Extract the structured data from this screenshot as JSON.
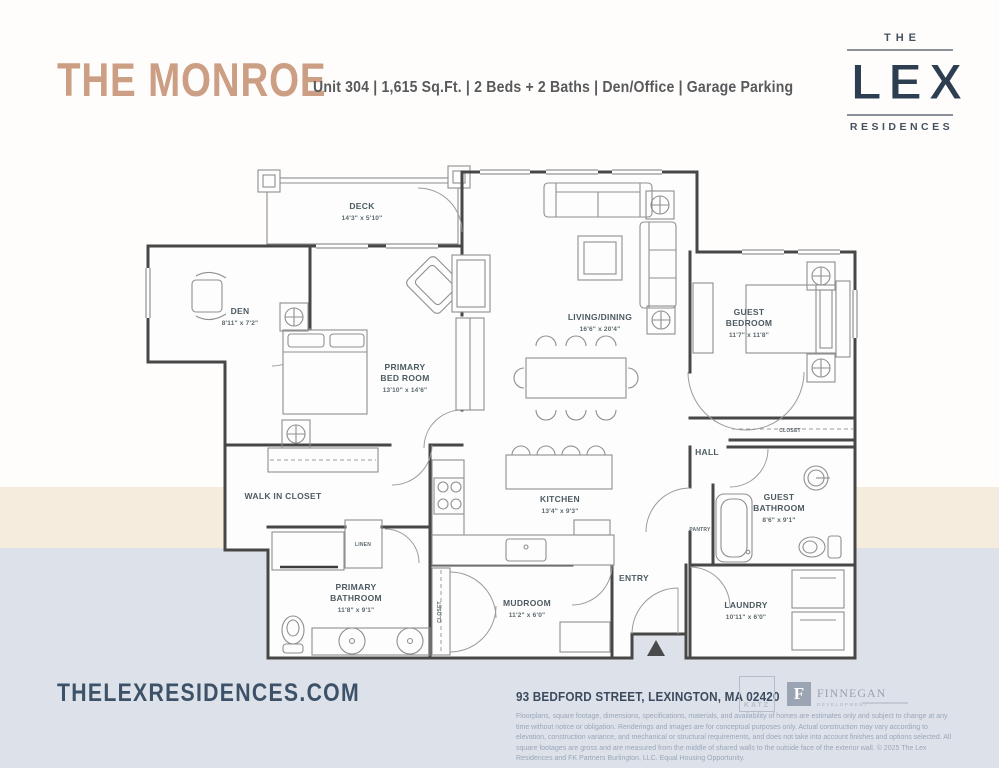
{
  "colors": {
    "accent_tan": "#cc9f85",
    "brand_navy": "#2d3e50",
    "label_slate": "#4d5b61",
    "band_beige": "#f5ecde",
    "band_blue": "#dde2ea"
  },
  "header": {
    "title": "THE MONROE",
    "subtitle": "Unit 304  |  1,615 Sq.Ft.  |  2 Beds + 2 Baths  |  Den/Office  |  Garage Parking",
    "logo": {
      "the": "THE",
      "lex": "LEX",
      "residences": "RESIDENCES"
    }
  },
  "floorplan": {
    "rooms": {
      "deck": {
        "name": "DECK",
        "dims": "14'3\" x 5'10\""
      },
      "den": {
        "name": "DEN",
        "dims": "8'11\" x 7'2\""
      },
      "primary_bedroom": {
        "name1": "PRIMARY",
        "name2": "BED ROOM",
        "dims": "13'10\" x 14'6\""
      },
      "living_dining": {
        "name": "LIVING/DINING",
        "dims": "16'6\" x 20'4\""
      },
      "guest_bedroom": {
        "name1": "GUEST",
        "name2": "BEDROOM",
        "dims": "11'7\" x 11'8\""
      },
      "walk_in_closet": {
        "name": "WALK IN CLOSET"
      },
      "kitchen": {
        "name": "KITCHEN",
        "dims": "13'4\" x 9'3\""
      },
      "primary_bathroom": {
        "name1": "PRIMARY",
        "name2": "BATHROOM",
        "dims": "11'8\" x 9'1\""
      },
      "mudroom": {
        "name": "MUDROOM",
        "dims": "11'2\" x 6'0\""
      },
      "guest_bathroom": {
        "name1": "GUEST",
        "name2": "BATHROOM",
        "dims": "8'6\" x 9'1\""
      },
      "laundry": {
        "name": "LAUNDRY",
        "dims": "10'11\" x 6'0\""
      },
      "hall": {
        "name": "HALL"
      },
      "entry": {
        "name": "ENTRY"
      },
      "pantry": {
        "name": "PANTRY"
      },
      "linen": {
        "name": "LINEN"
      },
      "closet_guest": {
        "name": "CLOSET"
      },
      "closet_mudroom": {
        "name": "CLOSET"
      }
    }
  },
  "footer": {
    "website": "THELEXRESIDENCES.COM",
    "address": "93 BEDFORD STREET, LEXINGTON, MA 02420",
    "disclaimer": "Floorplans, square footage, dimensions, specifications, materials, and availability of homes are estimates only and subject to change at any time without notice or obligation. Renderings and images are for conceptual purposes only. Actual construction may vary according to elevation, construction variance, and mechanical or structural requirements, and does not take into account finishes and options selected. All square footages are gross and are measured from the middle of shared walls to the outside face of the exterior wall. © 2025 The Lex Residences and FK Partners Burlington, LLC.  Equal Housing Opportunity.",
    "logos": {
      "katz": "KATZ",
      "finnegan_initial": "F",
      "finnegan": "FINNEGAN",
      "finnegan_sub": "DEVELOPMENT"
    }
  }
}
